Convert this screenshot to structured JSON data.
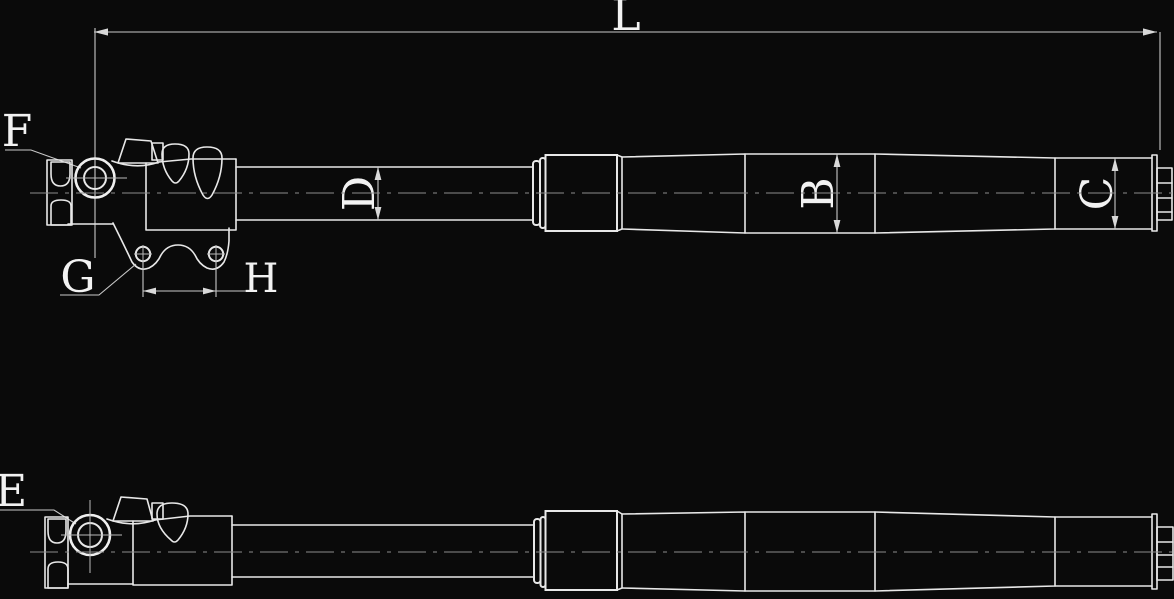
{
  "canvas": {
    "width": 1174,
    "height": 599,
    "background": "#0a0a0a"
  },
  "colors": {
    "part_outline": "#e8e8e8",
    "dimension_lines": "#c9c9c9",
    "centerline": "#8c8c8c",
    "label_text": "#f2f2f2"
  },
  "labels": {
    "overall_length": "L",
    "axle_clamp_callout_top": "F",
    "fender_bracket_callout": "G",
    "bracket_hole_spacing": "H",
    "inner_tube_diameter": "D",
    "outer_tube_diameter": "B",
    "end_section_diameter": "C",
    "axle_clamp_callout_bottom": "E"
  }
}
